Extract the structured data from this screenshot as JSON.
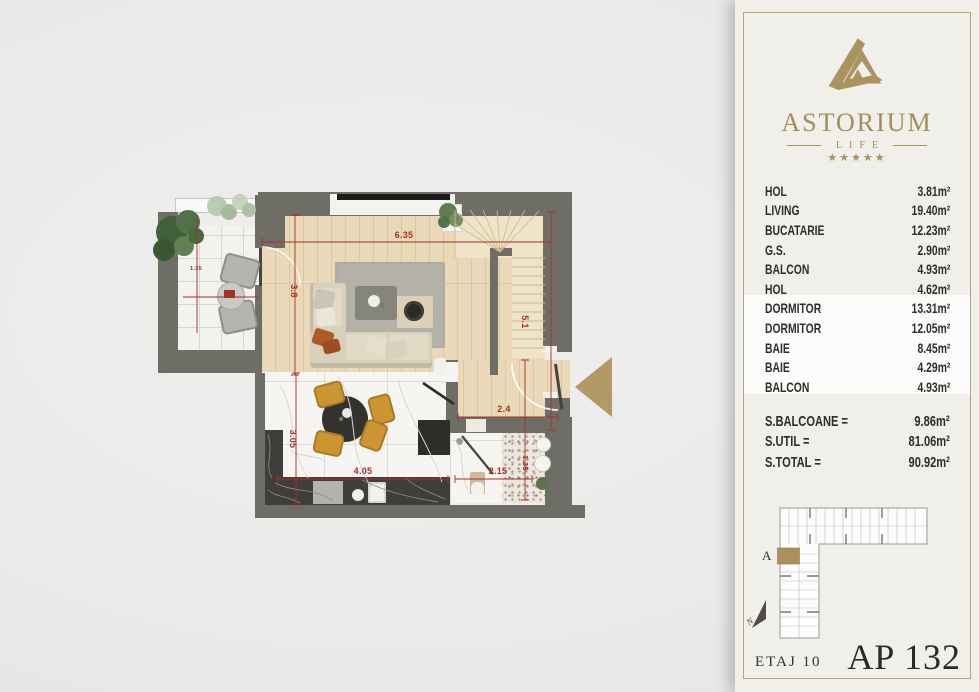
{
  "colors": {
    "gold": "#ab9361",
    "red": "#a5302a",
    "wall": "#6e6e66",
    "panel_bg": "#f1efe9",
    "frame_gold": "#b5a478"
  },
  "panel": {
    "brand": {
      "name": "ASTORIUM",
      "sub": "LIFE",
      "stars": "★★★★★"
    },
    "rooms": [
      {
        "label": "HOL",
        "area": "3.81m²"
      },
      {
        "label": "LIVING",
        "area": "19.40m²"
      },
      {
        "label": "BUCATARIE",
        "area": "12.23m²"
      },
      {
        "label": "G.S.",
        "area": "2.90m²"
      },
      {
        "label": "BALCON",
        "area": "4.93m²"
      },
      {
        "label": "HOL",
        "area": "4.62m²"
      },
      {
        "label": "DORMITOR",
        "area": "13.31m²"
      },
      {
        "label": "DORMITOR",
        "area": "12.05m²"
      },
      {
        "label": "BAIE",
        "area": "8.45m²"
      },
      {
        "label": "BAIE",
        "area": "4.29m²"
      },
      {
        "label": "BALCON",
        "area": "4.93m²"
      }
    ],
    "totals": [
      {
        "label": "S.BALCOANE =",
        "value": "9.86m²"
      },
      {
        "label": "S.UTIL =",
        "value": "81.06m²"
      },
      {
        "label": "S.TOTAL =",
        "value": "90.92m²"
      }
    ],
    "keyplan": {
      "block_label": "A",
      "compass": "N"
    },
    "footer": {
      "floor": "ETAJ 10",
      "apartment": "AP 132"
    }
  },
  "floorplan": {
    "dimensions": [
      {
        "text": "6.35"
      },
      {
        "text": "3.8"
      },
      {
        "text": "5.1"
      },
      {
        "text": "2.4"
      },
      {
        "text": "3.05"
      },
      {
        "text": "4.05"
      },
      {
        "text": "2.15"
      },
      {
        "text": "1.35"
      },
      {
        "text": "1.35"
      }
    ]
  }
}
